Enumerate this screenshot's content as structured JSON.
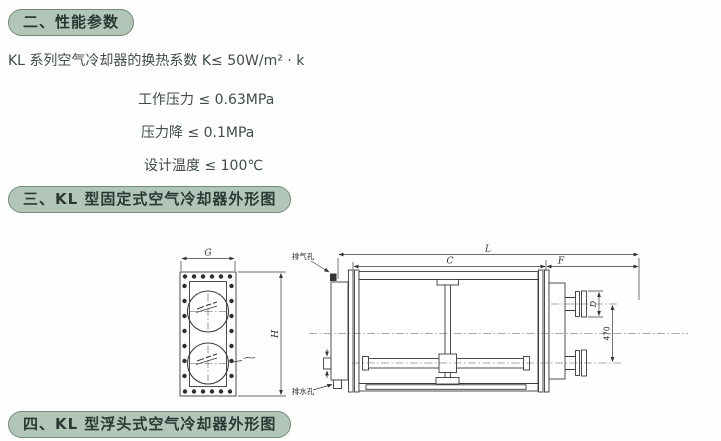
{
  "colors": {
    "header_bg": "#b1c6b9",
    "header_border": "#75897d",
    "header_text": "#2c3833",
    "body_text": "#3f4c49",
    "line": "#3a3a3a"
  },
  "sections": {
    "performance": {
      "title": "二、性能参数"
    },
    "fixed_outline": {
      "title": "三、KL 型固定式空气冷却器外形图"
    },
    "floating_outline": {
      "title": "四、KL 型浮头式空气冷却器外形图"
    }
  },
  "specs": {
    "heat_transfer": "KL 系列空气冷却器的换热系数 K≤ 50W/m² · k",
    "items": [
      "工作压力 ≤ 0.63MPa",
      "压力降 ≤ 0.1MPa",
      "设计温度 ≤ 100℃"
    ]
  },
  "drawing": {
    "dim_G": "G",
    "dim_H": "H",
    "dim_L": "L",
    "dim_C": "C",
    "dim_F": "F",
    "dim_D": "D",
    "dim_470": "470",
    "label_vent": "排气孔",
    "label_drain": "排水孔"
  }
}
